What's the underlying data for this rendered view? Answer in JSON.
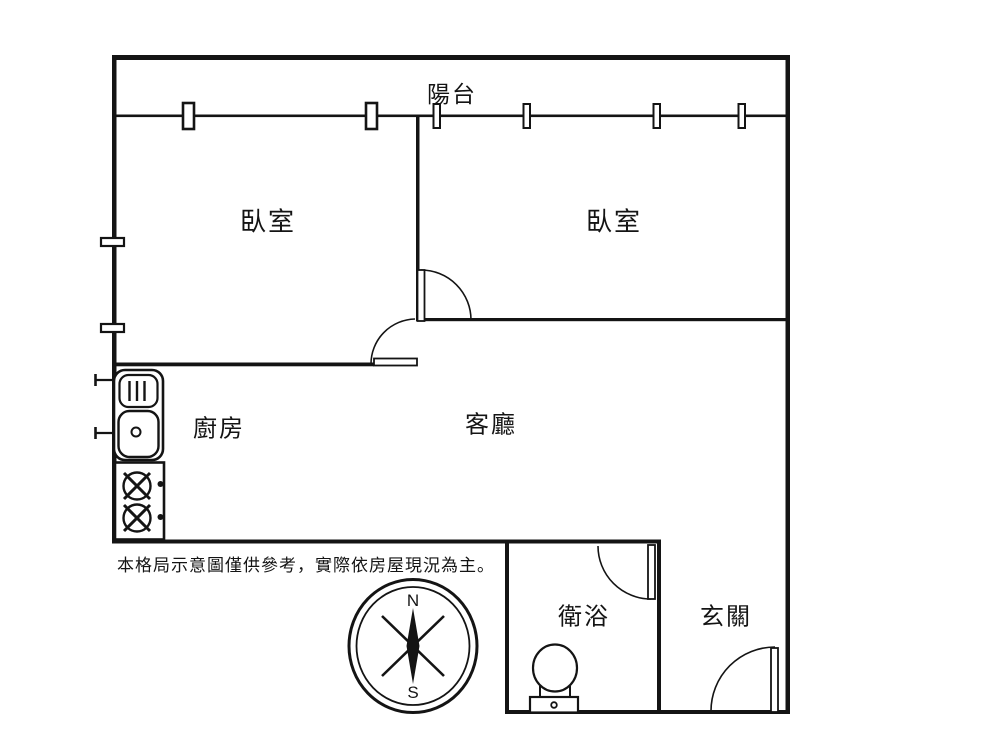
{
  "page": {
    "background_color": "#ffffff",
    "line_color": "#141414"
  },
  "floor_plan": {
    "rooms": [
      {
        "id": "balcony",
        "label": "陽台"
      },
      {
        "id": "bedroom-left",
        "label": "臥室"
      },
      {
        "id": "bedroom-right",
        "label": "臥室"
      },
      {
        "id": "kitchen",
        "label": "廚房"
      },
      {
        "id": "living-room",
        "label": "客廳"
      },
      {
        "id": "bathroom",
        "label": "衛浴"
      },
      {
        "id": "entry",
        "label": "玄關"
      }
    ],
    "compass": {
      "north_label": "N",
      "south_label": "S"
    },
    "disclaimer": "本格局示意圖僅供參考，實際依房屋現況為主。"
  }
}
